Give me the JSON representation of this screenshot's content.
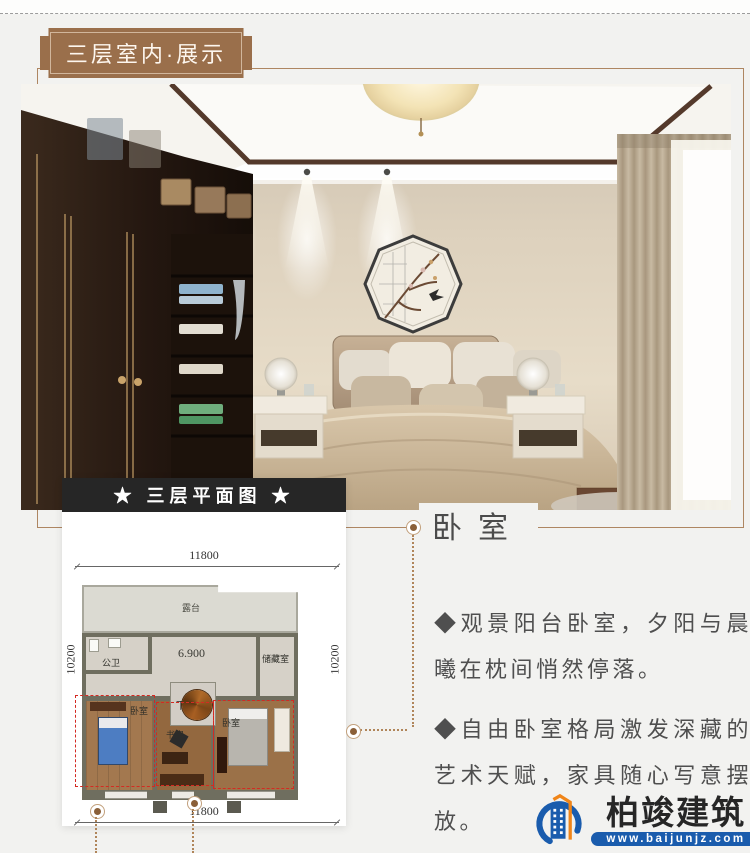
{
  "page": {
    "background": "#f2f2f0",
    "frame_color": "#ae8662",
    "dashed_red": "#d42a22"
  },
  "badge": {
    "label": "三层室内·展示",
    "background": "#9a6f4b"
  },
  "photo": {
    "colors": {
      "wardrobe": "#241710",
      "wall": "#ddd1bd",
      "curtain": "#c8baa3",
      "bedding": "#cdb795",
      "ceiling_trim": "#54392b"
    }
  },
  "plan": {
    "title": "★ 三层平面图 ★",
    "dim_top": "11800",
    "dim_bottom": "11800",
    "dim_left": "10200",
    "dim_right": "10200",
    "elevation": "6.900",
    "rooms": {
      "terrace": "露台",
      "bath": "公卫",
      "storage": "储藏室",
      "down": "下",
      "bedroom_left": "卧室",
      "study": "书房",
      "bedroom_right": "卧室"
    }
  },
  "section": {
    "title": "卧室",
    "paragraphs": [
      "◆观景阳台卧室，夕阳与晨曦在枕间悄然停落。",
      "◆自由卧室格局激发深藏的艺术天赋，家具随心写意摆放。"
    ]
  },
  "logo": {
    "brand": "柏竣建筑",
    "website": "www.baijunjz.com",
    "blue": "#1a5cad",
    "orange": "#f08519"
  }
}
